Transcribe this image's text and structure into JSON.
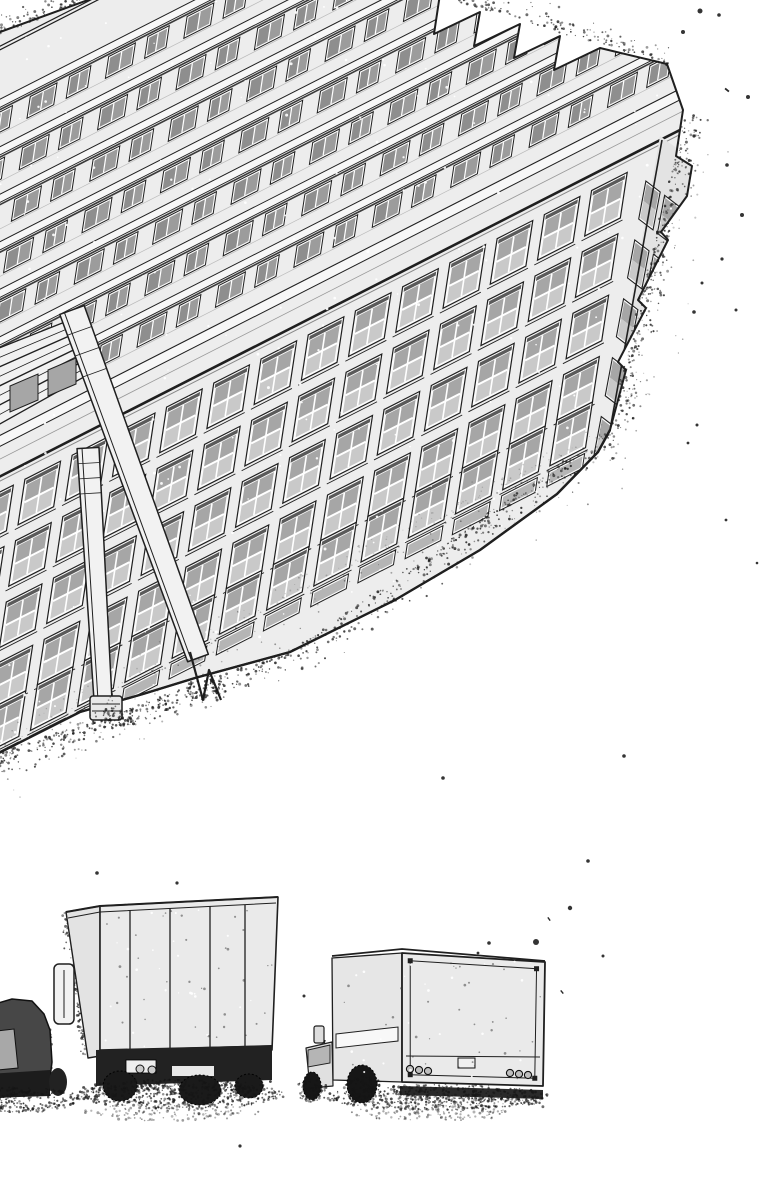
{
  "canvas": {
    "width": 764,
    "height": 1200,
    "background": "#ffffff",
    "viewBox": "0 0 764 1200"
  },
  "palette": {
    "ink": "#1f1f1f",
    "wall": "#ededed",
    "wallShade": "#e3e3e3",
    "strip": "#f7f7f7",
    "frame": "#fbfbfb",
    "glassDark": "#8e8e8e",
    "glassMid": "#a6a6a6",
    "glassLight": "#c9c9c9",
    "recessShadow": "#5a5a5a",
    "dark": "#1a1a1a",
    "vanBody": "#474747",
    "truckBox": "#eaeaea",
    "speckle": "#1c1c1c",
    "toneDot": "#555555",
    "shadowLine": "#3a3a3a",
    "pillar": "#f2f2f2",
    "bridge": "#f1f1f1",
    "pinhole": "#ffffff"
  },
  "building": {
    "silhouette": [
      [
        -11,
        36
      ],
      [
        110,
        -8
      ],
      [
        440,
        -6
      ],
      [
        434,
        34
      ],
      [
        480,
        12
      ],
      [
        474,
        46
      ],
      [
        520,
        24
      ],
      [
        514,
        58
      ],
      [
        560,
        36
      ],
      [
        554,
        70
      ],
      [
        600,
        48
      ],
      [
        667,
        64
      ],
      [
        683,
        110
      ],
      [
        676,
        156
      ],
      [
        692,
        166
      ],
      [
        687,
        196
      ],
      [
        661,
        232
      ],
      [
        668,
        240
      ],
      [
        638,
        300
      ],
      [
        646,
        308
      ],
      [
        618,
        362
      ],
      [
        626,
        370
      ],
      [
        610,
        430
      ],
      [
        598,
        452
      ],
      [
        557,
        494
      ],
      [
        480,
        550
      ],
      [
        395,
        600
      ],
      [
        290,
        652
      ],
      [
        195,
        678
      ],
      [
        143,
        694
      ],
      [
        80,
        712
      ],
      [
        -11,
        758
      ]
    ],
    "affine": [
      0.891,
      -0.454,
      -0.15,
      0.99,
      38,
      458
    ],
    "ridgeLines": [
      -468,
      -472
    ],
    "terraces": {
      "bandTops": [
        -414,
        -362,
        -310,
        -258,
        -206,
        -154,
        -102
      ],
      "stripH": 9,
      "winTop": 14,
      "winH": 22,
      "unitPitch": 44,
      "unitWidths": [
        30,
        24
      ],
      "u0": -340,
      "u1": 760
    },
    "cornice": {
      "stripTop": -46,
      "stripBot": -34,
      "midLine": -20,
      "parapetY": -1,
      "underShadowY": 2
    },
    "facade": {
      "u0": -330,
      "u1": 700,
      "colPitch": 53,
      "winW": 40,
      "rowTops": [
        16,
        78,
        140,
        202,
        248
      ],
      "rowH": 46,
      "shortRow": {
        "v": 300,
        "h": 15
      }
    },
    "endFace": {
      "poly": [
        [
          660,
          136
        ],
        [
          704,
          168
        ],
        [
          699,
          214
        ],
        [
          608,
          434
        ]
      ],
      "matrix": [
        0.55,
        0.42,
        -0.18,
        0.95,
        648,
        150
      ],
      "cols": [
        6,
        40
      ],
      "rowsV": [
        30,
        92,
        154,
        216,
        278
      ],
      "winW": 26,
      "winH": 40,
      "arris": [
        [
          662,
          140
        ],
        [
          610,
          430
        ]
      ]
    },
    "pillars": [
      {
        "top": [
          72,
          310
        ],
        "foot": [
          198,
          658
        ],
        "w": 26,
        "type": "v-bracket",
        "bracket": [
          [
            190,
            652
          ],
          [
            203,
            700
          ],
          [
            209,
            670
          ],
          [
            221,
            700
          ]
        ]
      },
      {
        "top": [
          88,
          448
        ],
        "foot": [
          103,
          700
        ],
        "w": 22,
        "type": "foot-box",
        "box": [
          90,
          696,
          32,
          24
        ]
      }
    ],
    "bridge": {
      "outer": [
        [
          -11,
          352
        ],
        [
          80,
          316
        ],
        [
          100,
          368
        ],
        [
          -11,
          430
        ]
      ],
      "stripes": 7,
      "windows": [
        [
          [
            10,
            386
          ],
          [
            38,
            374
          ],
          [
            38,
            400
          ],
          [
            10,
            412
          ]
        ],
        [
          [
            48,
            370
          ],
          [
            76,
            358
          ],
          [
            76,
            384
          ],
          [
            48,
            396
          ]
        ]
      ]
    }
  },
  "vehicles": {
    "van": {
      "body": [
        [
          -12,
          1006
        ],
        [
          12,
          999
        ],
        [
          32,
          1001
        ],
        [
          44,
          1014
        ],
        [
          50,
          1030
        ],
        [
          52,
          1062
        ],
        [
          48,
          1094
        ],
        [
          -12,
          1098
        ]
      ],
      "window": [
        [
          -12,
          1032
        ],
        [
          14,
          1029
        ],
        [
          18,
          1068
        ],
        [
          -12,
          1071
        ]
      ],
      "skirt": [
        [
          -12,
          1074
        ],
        [
          50,
          1070
        ],
        [
          50,
          1096
        ],
        [
          -12,
          1098
        ]
      ],
      "wheel": [
        58,
        1082,
        9,
        14
      ]
    },
    "truckA": {
      "side": [
        [
          66,
          912
        ],
        [
          100,
          906
        ],
        [
          100,
          1056
        ],
        [
          88,
          1058
        ]
      ],
      "rear": [
        [
          100,
          906
        ],
        [
          278,
          897
        ],
        [
          272,
          1050
        ],
        [
          100,
          1056
        ]
      ],
      "roofA": [
        [
          66,
          912
        ],
        [
          100,
          906
        ],
        [
          278,
          897
        ]
      ],
      "roofB": [
        [
          68,
          918
        ],
        [
          100,
          912
        ],
        [
          276,
          903
        ]
      ],
      "panelsX": [
        130,
        170,
        210,
        245
      ],
      "panelTop": [
        [
          100,
          912
        ],
        [
          276,
          903
        ]
      ],
      "panelBot": [
        [
          100,
          1050
        ],
        [
          272,
          1046
        ]
      ],
      "handle": [
        54,
        964,
        20,
        60
      ],
      "bumper": [
        [
          96,
          1050
        ],
        [
          272,
          1045
        ],
        [
          272,
          1080
        ],
        [
          96,
          1086
        ]
      ],
      "plate": [
        126,
        1060,
        30,
        13
      ],
      "slot": [
        172,
        1066,
        42,
        10
      ],
      "lights": [
        [
          140,
          1069,
          4
        ],
        [
          152,
          1070,
          4
        ]
      ],
      "wheels": [
        [
          120,
          1086,
          17,
          15
        ],
        [
          200,
          1090,
          21,
          15
        ],
        [
          249,
          1086,
          14,
          12
        ]
      ]
    },
    "truckB": {
      "roof": [
        [
          332,
          956
        ],
        [
          402,
          949
        ],
        [
          545,
          961
        ]
      ],
      "roof2": [
        [
          334,
          961
        ],
        [
          402,
          954
        ],
        [
          543,
          966
        ]
      ],
      "side": [
        [
          332,
          958
        ],
        [
          402,
          953
        ],
        [
          402,
          1082
        ],
        [
          333,
          1080
        ]
      ],
      "stripe": [
        [
          336,
          1034
        ],
        [
          398,
          1027
        ],
        [
          398,
          1041
        ],
        [
          336,
          1048
        ]
      ],
      "rear": [
        [
          402,
          953
        ],
        [
          545,
          962
        ],
        [
          543,
          1086
        ],
        [
          402,
          1082
        ]
      ],
      "frameInset": 7,
      "innerLineY": 1056,
      "plate": [
        458,
        1058,
        17,
        10
      ],
      "lightsL": [
        [
          410,
          1069,
          3.6
        ],
        [
          419,
          1070,
          3.6
        ],
        [
          428,
          1071,
          3.6
        ]
      ],
      "lightsR": [
        [
          510,
          1073,
          3.6
        ],
        [
          519,
          1074,
          3.6
        ],
        [
          528,
          1075,
          3.6
        ]
      ],
      "bumper": [
        [
          400,
          1086
        ],
        [
          543,
          1090
        ],
        [
          543,
          1099
        ],
        [
          400,
          1095
        ]
      ],
      "mirrorHead": [
        314,
        1026,
        10,
        17
      ],
      "mirrorArm": [
        [
          322,
          1052
        ],
        [
          325,
          1040
        ]
      ],
      "cab": [
        [
          306,
          1048
        ],
        [
          332,
          1042
        ],
        [
          333,
          1086
        ],
        [
          310,
          1088
        ]
      ],
      "cabWindow": [
        [
          308,
          1050
        ],
        [
          330,
          1045
        ],
        [
          330,
          1063
        ],
        [
          308,
          1067
        ]
      ],
      "wheels": [
        [
          312,
          1086,
          9,
          14
        ],
        [
          362,
          1084,
          15,
          19
        ]
      ]
    }
  },
  "stipple": {
    "seed": 123457,
    "segments": [
      {
        "p1": [
          -11,
          758
        ],
        "p2": [
          290,
          652
        ],
        "n": 330,
        "spread": 30,
        "side": "out"
      },
      {
        "p1": [
          290,
          652
        ],
        "p2": [
          610,
          430
        ],
        "n": 330,
        "spread": 34,
        "side": "out"
      },
      {
        "p1": [
          -11,
          758
        ],
        "p2": [
          610,
          430
        ],
        "n": 170,
        "spread": 70,
        "side": "out",
        "rMax": 1.1,
        "op": 0.5
      },
      {
        "p1": [
          610,
          430
        ],
        "p2": [
          686,
          112
        ],
        "n": 260,
        "spread": 26,
        "side": "out"
      },
      {
        "p1": [
          610,
          430
        ],
        "p2": [
          686,
          112
        ],
        "n": 80,
        "spread": 62,
        "side": "out",
        "rMax": 1.1,
        "op": 0.5
      },
      {
        "p1": [
          440,
          -4
        ],
        "p2": [
          667,
          64
        ],
        "n": 160,
        "spread": 26,
        "side": "out"
      },
      {
        "p1": [
          -11,
          36
        ],
        "p2": [
          110,
          -8
        ],
        "n": 90,
        "spread": 20,
        "side": "out"
      },
      {
        "p1": [
          66,
          912
        ],
        "p2": [
          88,
          1058
        ],
        "n": 70,
        "spread": 7,
        "side": "out"
      },
      {
        "p1": [
          -12,
          1004
        ],
        "p2": [
          50,
          1028
        ],
        "n": 60,
        "spread": 6,
        "side": "out"
      },
      {
        "p1": [
          50,
          1028
        ],
        "p2": [
          50,
          1094
        ],
        "n": 50,
        "spread": 6,
        "side": "out"
      },
      {
        "p1": [
          96,
          1086
        ],
        "p2": [
          272,
          1080
        ],
        "n": 120,
        "spread": 10,
        "side": "out"
      },
      {
        "p1": [
          400,
          1094
        ],
        "p2": [
          543,
          1099
        ],
        "n": 100,
        "spread": 9,
        "side": "out"
      },
      {
        "p1": [
          -11,
          758
        ],
        "p2": [
          610,
          430
        ],
        "n": 200,
        "spread": 24,
        "side": "in",
        "col": "#555555",
        "op": 0.4,
        "rMax": 1.0
      }
    ],
    "ellipses": [
      {
        "c": [
          178,
          1094
        ],
        "r": [
          108,
          15
        ],
        "n": 520
      },
      {
        "c": [
          172,
          1112
        ],
        "r": [
          88,
          9
        ],
        "n": 150,
        "op": 0.5
      },
      {
        "c": [
          438,
          1097
        ],
        "r": [
          112,
          13
        ],
        "n": 460
      },
      {
        "c": [
          430,
          1113
        ],
        "r": [
          80,
          8
        ],
        "n": 130,
        "op": 0.5
      },
      {
        "c": [
          20,
          1100
        ],
        "r": [
          58,
          13
        ],
        "n": 260
      },
      {
        "c": [
          205,
          688
        ],
        "r": [
          20,
          12
        ],
        "n": 55
      },
      {
        "c": [
          116,
          716
        ],
        "r": [
          24,
          10
        ],
        "n": 55
      },
      {
        "c": [
          312,
          1090
        ],
        "r": [
          16,
          12
        ],
        "n": 70
      },
      {
        "c": [
          364,
          1090
        ],
        "r": [
          20,
          14
        ],
        "n": 80
      }
    ],
    "pinholes": {
      "n": 260,
      "box": [
        -10,
        0,
        700,
        760
      ]
    },
    "boxSpeckles": [
      {
        "box": [
          104,
          910,
          168,
          140
        ],
        "n": 60
      },
      {
        "box": [
          336,
          960,
          205,
          120
        ],
        "n": 55
      }
    ]
  },
  "flecks": [
    [
      700,
      11,
      2.5,
      0
    ],
    [
      719,
      15,
      1.8,
      0
    ],
    [
      683,
      32,
      2,
      0
    ],
    [
      727,
      90,
      5,
      40
    ],
    [
      748,
      97,
      2,
      0
    ],
    [
      694,
      136,
      1.6,
      0
    ],
    [
      727,
      165,
      1.8,
      0
    ],
    [
      742,
      215,
      2,
      0
    ],
    [
      722,
      259,
      1.6,
      0
    ],
    [
      702,
      283,
      1.5,
      0
    ],
    [
      694,
      312,
      1.8,
      0
    ],
    [
      736,
      310,
      1.5,
      0
    ],
    [
      697,
      425,
      1.5,
      0
    ],
    [
      688,
      443,
      1.4,
      0
    ],
    [
      624,
      756,
      1.8,
      0
    ],
    [
      443,
      778,
      1.8,
      0
    ],
    [
      588,
      861,
      1.8,
      0
    ],
    [
      549,
      919,
      4,
      55
    ],
    [
      536,
      942,
      3,
      45
    ],
    [
      489,
      943,
      1.8,
      0
    ],
    [
      478,
      953,
      1.4,
      0
    ],
    [
      570,
      908,
      2.2,
      60
    ],
    [
      603,
      956,
      1.5,
      0
    ],
    [
      562,
      992,
      4,
      50
    ],
    [
      97,
      873,
      1.8,
      0
    ],
    [
      177,
      883,
      1.6,
      0
    ],
    [
      304,
      996,
      1.5,
      0
    ],
    [
      240,
      1146,
      1.6,
      0
    ],
    [
      726,
      520,
      1.4,
      0
    ],
    [
      757,
      563,
      1.3,
      0
    ]
  ]
}
